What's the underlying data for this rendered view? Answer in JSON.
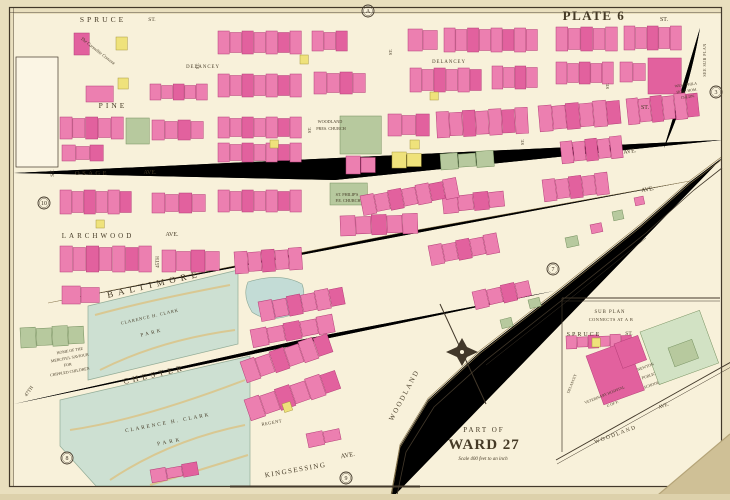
{
  "document": {
    "type": "atlas-plate",
    "plate_title": "PLATE 6",
    "area_title_line1": "PART OF",
    "area_title_line2": "WARD 27",
    "scale_note": "Scale 400 feet to an inch",
    "sub_plan_note": [
      "SUB PLAN",
      "CONNECTS AT A B"
    ]
  },
  "palette": {
    "paper": "#e9dfbe",
    "sheet": "#f8f1da",
    "street": "#efe0ad",
    "street_edge": "#8c7950",
    "ink": "#42382a",
    "p": "#ec7fb0",
    "p_stroke": "#b43e78",
    "P": "#e2619e",
    "y": "#efe27b",
    "y_stroke": "#a89a3e",
    "g": "#b7c99e",
    "g_stroke": "#75905f",
    "G": "#d2e2c4",
    "park": "#cde0d2",
    "park_stroke": "#93ac97",
    "pond": "#c3dcd6",
    "red": "#c43b52"
  },
  "map": {
    "labels": [
      {
        "t": "SPRUCE",
        "x": 103,
        "y": 22,
        "s": 7.5,
        "ls": 3,
        "n": "street-label-spruce"
      },
      {
        "t": "ST.",
        "x": 152,
        "y": 21,
        "s": 5.5,
        "n": "street-label-spruce-st"
      },
      {
        "t": "PLATE 6",
        "x": 594,
        "y": 20,
        "s": 13,
        "ls": 1.5,
        "w": 600,
        "c": "#43392a",
        "n": "plate-title"
      },
      {
        "t": "ST.",
        "x": 664,
        "y": 21,
        "s": 6,
        "n": "street-label-spruce-st-right"
      },
      {
        "t": "DELANCEY",
        "x": 203,
        "y": 68,
        "s": 4.8,
        "ls": 1,
        "n": "street-label-delancey-left"
      },
      {
        "t": "DELANCEY",
        "x": 449,
        "y": 63,
        "s": 4.8,
        "ls": 1,
        "n": "street-label-delancey-right"
      },
      {
        "t": "PINE",
        "x": 113,
        "y": 108,
        "s": 7.5,
        "ls": 3,
        "n": "street-label-pine"
      },
      {
        "t": "ST.",
        "x": 645,
        "y": 109,
        "s": 6,
        "n": "street-label-pine-st"
      },
      {
        "t": "OSAGE",
        "x": 92,
        "y": 175,
        "s": 6.5,
        "ls": 2.5,
        "n": "street-label-osage"
      },
      {
        "t": "AVE.",
        "x": 150,
        "y": 174,
        "s": 6,
        "n": "street-label-osage-ave"
      },
      {
        "t": "LARCHWOOD",
        "x": 98,
        "y": 238,
        "s": 7,
        "ls": 3,
        "n": "street-label-larchwood"
      },
      {
        "t": "AVE.",
        "x": 172,
        "y": 236,
        "s": 6,
        "n": "street-label-larchwood-ave"
      },
      {
        "t": "BALTIMORE",
        "x": 155,
        "y": 287,
        "s": 9,
        "ls": 5,
        "r": -13,
        "n": "street-label-baltimore"
      },
      {
        "t": "AVE.",
        "x": 630,
        "y": 153,
        "s": 6,
        "r": -8,
        "n": "street-label-ave-upper-right"
      },
      {
        "t": "AVE.",
        "x": 648,
        "y": 191,
        "s": 6,
        "r": -10,
        "n": "street-label-baltimore-ave-right"
      },
      {
        "t": "CHESTER",
        "x": 155,
        "y": 377,
        "s": 8,
        "ls": 4,
        "r": -13,
        "n": "street-label-chester"
      },
      {
        "t": "KINGSESSING",
        "x": 296,
        "y": 472,
        "s": 7,
        "ls": 1.5,
        "r": -10,
        "n": "street-label-kingsessing"
      },
      {
        "t": "AVE.",
        "x": 348,
        "y": 457,
        "s": 6.5,
        "r": -10,
        "n": "street-label-kingsessing-ave"
      },
      {
        "t": "WOODLAND",
        "x": 406,
        "y": 396,
        "s": 7,
        "ls": 2,
        "r": -62,
        "n": "street-label-woodland"
      },
      {
        "t": "REGENT",
        "x": 272,
        "y": 424,
        "s": 4.5,
        "ls": 0.5,
        "r": -10,
        "n": "street-label-regent"
      },
      {
        "t": "45TH",
        "x": 159,
        "y": 262,
        "s": 5,
        "r": -90,
        "n": "street-label-45th"
      },
      {
        "t": "47TH",
        "x": 30,
        "y": 392,
        "s": 5,
        "r": -55,
        "n": "street-label-47th"
      },
      {
        "t": "ST.",
        "x": 54,
        "y": 173,
        "s": 5.5,
        "r": -90,
        "n": "street-label-st-v1"
      },
      {
        "t": "ST.",
        "x": 199,
        "y": 66,
        "s": 4.5,
        "r": -90,
        "n": "street-label-st-v3"
      },
      {
        "t": "ST.",
        "x": 311,
        "y": 130,
        "s": 4.5,
        "r": -90,
        "n": "street-label-st-v5"
      },
      {
        "t": "ST.",
        "x": 392,
        "y": 52,
        "s": 4.5,
        "r": -90,
        "n": "street-label-st-v7"
      },
      {
        "t": "ST.",
        "x": 524,
        "y": 142,
        "s": 4.5,
        "r": -90,
        "n": "street-label-st-v9"
      },
      {
        "t": "ST.",
        "x": 609,
        "y": 86,
        "s": 4.5,
        "r": -90,
        "n": "street-label-st-v10"
      },
      {
        "t": "SEE SUB PLAN",
        "x": 706,
        "y": 60,
        "s": 4,
        "ls": 0.5,
        "r": -90,
        "n": "see-sub-plan-note"
      },
      {
        "t": "The Carmelite Convent",
        "x": 97,
        "y": 52,
        "s": 4.5,
        "r": 38,
        "i": 1,
        "n": "carmelite-convent-label"
      },
      {
        "t": "WOODLAND",
        "x": 330,
        "y": 123,
        "s": 4.2,
        "n": "woodland-pres-church-label-1"
      },
      {
        "t": "PRES. CHURCH",
        "x": 331,
        "y": 130,
        "s": 4.2,
        "n": "woodland-pres-church-label-2"
      },
      {
        "t": "ST. PHILIP'S",
        "x": 347,
        "y": 196,
        "s": 4.2,
        "n": "st-philips-church-label-1"
      },
      {
        "t": "P.E. CHURCH",
        "x": 348,
        "y": 202,
        "s": 4.2,
        "n": "st-philips-church-label-2"
      },
      {
        "t": "WEST PHILA",
        "x": 686,
        "y": 86,
        "s": 3.8,
        "r": -8,
        "n": "west-phila-hospital-label-1"
      },
      {
        "t": "HOSP. HOM.",
        "x": 687,
        "y": 92,
        "s": 3.8,
        "r": -8,
        "n": "west-phila-hospital-label-2"
      },
      {
        "t": "CHLDN.",
        "x": 688,
        "y": 98,
        "s": 3.8,
        "r": -8,
        "n": "west-phila-hospital-label-3"
      },
      {
        "t": "HOME OF THE",
        "x": 70,
        "y": 352,
        "s": 4,
        "r": -10,
        "n": "merciful-saviour-label-1"
      },
      {
        "t": "MERCIFUL SAVIOUR",
        "x": 70,
        "y": 359,
        "s": 4,
        "r": -10,
        "n": "merciful-saviour-label-2"
      },
      {
        "t": "FOR",
        "x": 68,
        "y": 366,
        "s": 4,
        "r": -10,
        "n": "merciful-saviour-label-3"
      },
      {
        "t": "CRIPPLED CHILDREN",
        "x": 70,
        "y": 373,
        "s": 4,
        "r": -10,
        "n": "merciful-saviour-label-4"
      },
      {
        "t": "CLARENCE H. CLARK",
        "x": 150,
        "y": 318,
        "s": 4.5,
        "ls": 0.8,
        "r": -13,
        "n": "clark-park-upper-label-1"
      },
      {
        "t": "PARK",
        "x": 152,
        "y": 334,
        "s": 5,
        "ls": 2.5,
        "r": -13,
        "n": "clark-park-upper-label-2"
      },
      {
        "t": "CLARENCE H. CLARK",
        "x": 168,
        "y": 424,
        "s": 5.2,
        "ls": 2,
        "r": -11,
        "n": "clark-park-lower-label-1"
      },
      {
        "t": "PARK",
        "x": 170,
        "y": 443,
        "s": 5.2,
        "ls": 3,
        "r": -11,
        "n": "clark-park-lower-label-2"
      },
      {
        "t": "SUB PLAN",
        "x": 610,
        "y": 313,
        "s": 4.8,
        "ls": 1,
        "n": "sub-plan-title-1"
      },
      {
        "t": "CONNECTS AT A B",
        "x": 611,
        "y": 321,
        "s": 4.4,
        "ls": 0.5,
        "n": "sub-plan-title-2"
      },
      {
        "t": "SPRUCE",
        "x": 584,
        "y": 336,
        "s": 6,
        "ls": 2,
        "n": "inset-street-label-spruce"
      },
      {
        "t": "ST.",
        "x": 629,
        "y": 335,
        "s": 5.5,
        "n": "inset-street-label-spruce-st"
      },
      {
        "t": "DELANCEY",
        "x": 573,
        "y": 384,
        "s": 3.8,
        "r": -68,
        "n": "inset-street-label-delancey"
      },
      {
        "t": "VETERINARY HOSPITAL",
        "x": 605,
        "y": 396,
        "s": 3.8,
        "r": -22,
        "n": "inset-vet-hospital-label-1"
      },
      {
        "t": "U OF P.",
        "x": 613,
        "y": 405,
        "s": 3.8,
        "r": -22,
        "n": "inset-vet-hospital-label-2"
      },
      {
        "t": "NEWTON",
        "x": 646,
        "y": 368,
        "s": 4,
        "r": -20,
        "n": "inset-newton-school-label-1"
      },
      {
        "t": "PUBLIC",
        "x": 649,
        "y": 377,
        "s": 4,
        "r": -20,
        "n": "inset-newton-school-label-2"
      },
      {
        "t": "SCHOOL",
        "x": 652,
        "y": 386,
        "s": 4,
        "r": -20,
        "n": "inset-newton-school-label-3"
      },
      {
        "t": "WOODLAND",
        "x": 616,
        "y": 436,
        "s": 5.5,
        "ls": 1.5,
        "r": -20,
        "n": "inset-street-label-woodland"
      },
      {
        "t": "AVE.",
        "x": 664,
        "y": 407,
        "s": 5,
        "r": -20,
        "n": "inset-street-label-woodland-ave"
      },
      {
        "t": "PART OF",
        "x": 484,
        "y": 432,
        "s": 7,
        "ls": 2,
        "n": "area-title-part-of"
      },
      {
        "t": "WARD 27",
        "x": 484,
        "y": 449,
        "s": 15,
        "ls": 1,
        "w": 700,
        "c": "#6b5b41",
        "n": "area-title-ward-27"
      },
      {
        "t": "Scale 400 feet to an inch",
        "x": 483,
        "y": 460,
        "s": 5,
        "i": 1,
        "n": "scale-note"
      }
    ],
    "markers": [
      {
        "t": "A",
        "x": 368,
        "y": 11,
        "n": "edge-marker-a"
      },
      {
        "t": "3",
        "x": 716,
        "y": 92,
        "n": "edge-marker-3"
      },
      {
        "t": "7",
        "x": 553,
        "y": 269,
        "n": "edge-marker-7"
      },
      {
        "t": "10",
        "x": 44,
        "y": 203,
        "n": "edge-marker-10"
      },
      {
        "t": "8",
        "x": 67,
        "y": 458,
        "n": "edge-marker-8"
      },
      {
        "t": "9",
        "x": 346,
        "y": 478,
        "n": "edge-marker-9"
      }
    ],
    "buildings": [
      [
        218,
        31,
        84,
        23,
        7,
        "p"
      ],
      [
        312,
        31,
        36,
        20,
        3,
        "p"
      ],
      [
        408,
        29,
        30,
        22,
        2,
        "p"
      ],
      [
        444,
        28,
        94,
        24,
        8,
        "p"
      ],
      [
        556,
        27,
        62,
        24,
        5,
        "p"
      ],
      [
        624,
        26,
        58,
        24,
        5,
        "p"
      ],
      [
        218,
        74,
        84,
        23,
        7,
        "p"
      ],
      [
        314,
        72,
        52,
        22,
        4,
        "p"
      ],
      [
        410,
        68,
        72,
        24,
        6,
        "p"
      ],
      [
        492,
        66,
        46,
        23,
        4,
        "p"
      ],
      [
        556,
        62,
        58,
        22,
        5,
        "p"
      ],
      [
        620,
        62,
        26,
        20,
        2,
        "p"
      ],
      [
        648,
        58,
        34,
        36,
        1,
        "P"
      ],
      [
        74,
        33,
        16,
        22,
        1,
        "P"
      ],
      [
        116,
        37,
        12,
        13,
        1,
        "y"
      ],
      [
        86,
        86,
        28,
        16,
        1,
        "p"
      ],
      [
        150,
        84,
        58,
        16,
        5,
        "p"
      ],
      [
        118,
        78,
        11,
        11,
        1,
        "y"
      ],
      [
        126,
        118,
        24,
        26,
        1,
        "g"
      ],
      [
        60,
        117,
        64,
        22,
        5,
        "p"
      ],
      [
        152,
        120,
        52,
        20,
        4,
        "p"
      ],
      [
        218,
        117,
        84,
        21,
        7,
        "p"
      ],
      [
        218,
        143,
        84,
        19,
        7,
        "p"
      ],
      [
        62,
        145,
        42,
        16,
        3,
        "p"
      ],
      [
        340,
        116,
        42,
        38,
        1,
        "g"
      ],
      [
        388,
        114,
        42,
        22,
        3,
        "p"
      ],
      [
        436,
        112,
        92,
        26,
        7,
        "p",
        -3
      ],
      [
        538,
        106,
        82,
        26,
        6,
        "p",
        -5
      ],
      [
        626,
        99,
        72,
        26,
        6,
        "p",
        -6
      ],
      [
        346,
        156,
        30,
        18,
        2,
        "p"
      ],
      [
        392,
        152,
        30,
        16,
        2,
        "y"
      ],
      [
        352,
        186,
        16,
        13,
        1,
        "y"
      ],
      [
        440,
        154,
        54,
        16,
        3,
        "g",
        -4
      ],
      [
        560,
        142,
        62,
        22,
        5,
        "p",
        -6
      ],
      [
        60,
        190,
        72,
        24,
        6,
        "p"
      ],
      [
        152,
        193,
        54,
        20,
        4,
        "p"
      ],
      [
        218,
        190,
        84,
        22,
        7,
        "p"
      ],
      [
        330,
        183,
        38,
        22,
        1,
        "g"
      ],
      [
        340,
        216,
        78,
        20,
        5,
        "p",
        -2
      ],
      [
        442,
        196,
        62,
        18,
        4,
        "p",
        -6
      ],
      [
        542,
        180,
        66,
        22,
        5,
        "p",
        -7
      ],
      [
        60,
        246,
        92,
        26,
        7,
        "p"
      ],
      [
        162,
        250,
        58,
        22,
        4,
        "p"
      ],
      [
        234,
        252,
        68,
        22,
        5,
        "p",
        -4
      ],
      [
        360,
        196,
        98,
        20,
        7,
        "p",
        -11
      ],
      [
        258,
        302,
        86,
        20,
        6,
        "p",
        -11
      ],
      [
        250,
        330,
        84,
        18,
        5,
        "p",
        -11
      ],
      [
        62,
        286,
        38,
        18,
        2,
        "p"
      ],
      [
        428,
        246,
        70,
        20,
        5,
        "p",
        -11
      ],
      [
        472,
        292,
        58,
        18,
        4,
        "p",
        -13
      ],
      [
        240,
        362,
        92,
        22,
        6,
        "p",
        -19
      ],
      [
        244,
        400,
        96,
        22,
        6,
        "p",
        -19
      ],
      [
        306,
        434,
        34,
        14,
        2,
        "p",
        -12
      ],
      [
        150,
        470,
        48,
        13,
        3,
        "p",
        -10
      ],
      [
        565,
        238,
        13,
        10,
        1,
        "g",
        -12
      ],
      [
        590,
        225,
        12,
        9,
        1,
        "p",
        -12
      ],
      [
        612,
        212,
        11,
        9,
        1,
        "g",
        -12
      ],
      [
        634,
        198,
        10,
        8,
        1,
        "p",
        -12
      ],
      [
        500,
        320,
        12,
        9,
        1,
        "g",
        -14
      ],
      [
        528,
        300,
        12,
        9,
        1,
        "g",
        -14
      ],
      [
        20,
        328,
        64,
        20,
        4,
        "g",
        -3
      ],
      [
        566,
        336,
        66,
        13,
        6,
        "p",
        -2
      ],
      [
        640,
        332,
        64,
        56,
        1,
        "G",
        -20
      ],
      [
        668,
        348,
        26,
        20,
        1,
        "g",
        -20
      ],
      [
        586,
        356,
        44,
        52,
        1,
        "P",
        -20
      ],
      [
        614,
        344,
        26,
        26,
        1,
        "P",
        -20
      ],
      [
        300,
        55,
        9,
        9,
        1,
        "y"
      ],
      [
        430,
        92,
        9,
        8,
        1,
        "y"
      ],
      [
        270,
        140,
        9,
        8,
        1,
        "y"
      ],
      [
        96,
        220,
        9,
        8,
        1,
        "y"
      ],
      [
        282,
        404,
        9,
        9,
        1,
        "y",
        -18
      ],
      [
        410,
        140,
        10,
        9,
        1,
        "y"
      ],
      [
        592,
        338,
        9,
        9,
        1,
        "y"
      ]
    ]
  }
}
